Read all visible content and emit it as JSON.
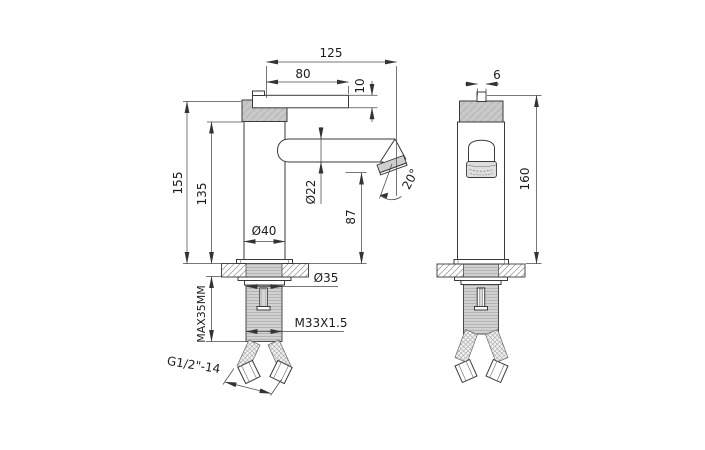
{
  "drawing": {
    "title": "Basin mixer faucet dimensional drawing",
    "views": {
      "side": "side view",
      "front": "front view"
    },
    "dimensions": {
      "spout_reach": "125",
      "lever_length": "80",
      "lever_thickness": "10",
      "handle_pin_width": "6",
      "height_overall_side": "155",
      "body_height": "135",
      "spout_diameter": "Ø22",
      "spout_outlet_height": "87",
      "body_diameter": "Ø40",
      "base_diameter": "Ø35",
      "max_deck_thickness": "MAX35MM",
      "mounting_thread": "M33X1.5",
      "hose_thread": "G1/2\"-14",
      "spout_angle": "20°",
      "height_overall_front": "160"
    }
  }
}
